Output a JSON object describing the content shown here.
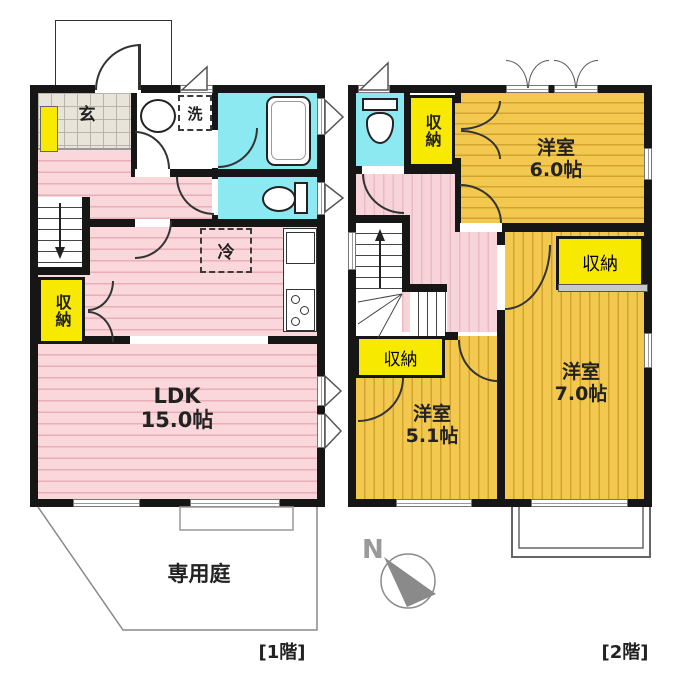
{
  "floor1": {
    "floor_label": "[1階]",
    "ldk": {
      "name": "LDK",
      "size": "15.0帖"
    },
    "genkan_label": "玄",
    "laundry_label": "洗",
    "fridge_label": "冷",
    "closet_label": "収納",
    "garden_label": "専用庭"
  },
  "floor2": {
    "floor_label": "[2階]",
    "room_6": {
      "name": "洋室",
      "size": "6.0帖"
    },
    "room_7": {
      "name": "洋室",
      "size": "7.0帖"
    },
    "room_51": {
      "name": "洋室",
      "size": "5.1帖"
    },
    "closet_north_label": "収納",
    "closet_east_label": "収納",
    "closet_south_label": "収納"
  },
  "compass": {
    "north_label": "N"
  },
  "colors": {
    "wall": "#161616",
    "room_pink": "#f9d7db",
    "room_pink_stripe": "#e9aeb8",
    "room_yellow": "#f2c94e",
    "room_yellow_stripe": "#d3a231",
    "closet_yellow": "#f7ea00",
    "wet_area_cyan": "#8ce9f2",
    "entry_tile": "#e8e4da"
  }
}
